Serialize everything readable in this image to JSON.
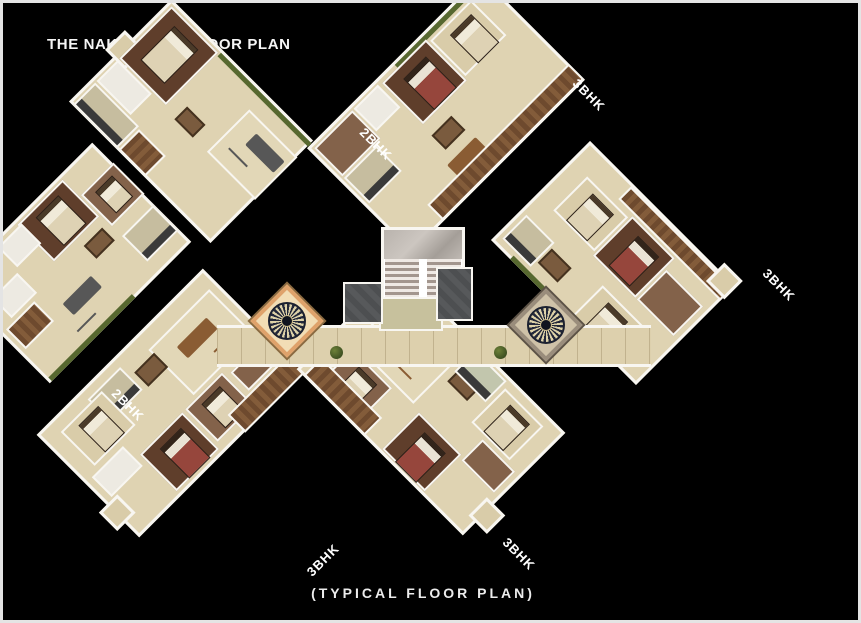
{
  "window": {
    "title": "THE NAKSHATRA FLOOR PLAN",
    "caption": "(TYPICAL FLOOR PLAN)"
  },
  "units": [
    {
      "label": "2BHK",
      "position": "top"
    },
    {
      "label": "3BHK",
      "position": "top-right"
    },
    {
      "label": "3BHK",
      "position": "right"
    },
    {
      "label": "2BHK",
      "position": "left"
    },
    {
      "label": "3BHK",
      "position": "bottom-left"
    },
    {
      "label": "3BHK",
      "position": "bottom-right"
    }
  ],
  "colors": {
    "background": "#000000",
    "frame_border": "#e4e4e4",
    "text": "#f5f5f5",
    "wall_white": "#f8f6f1",
    "floor_beige": "#dfd3b2",
    "floor_dark_brown": "#5f3e2b",
    "wood_deck": "#6e4a2e",
    "bed_maroon": "#96463c",
    "lift_gray": "#4d4f51",
    "hedge_green": "#57682f",
    "medallion_accent": "#dfa26b"
  }
}
